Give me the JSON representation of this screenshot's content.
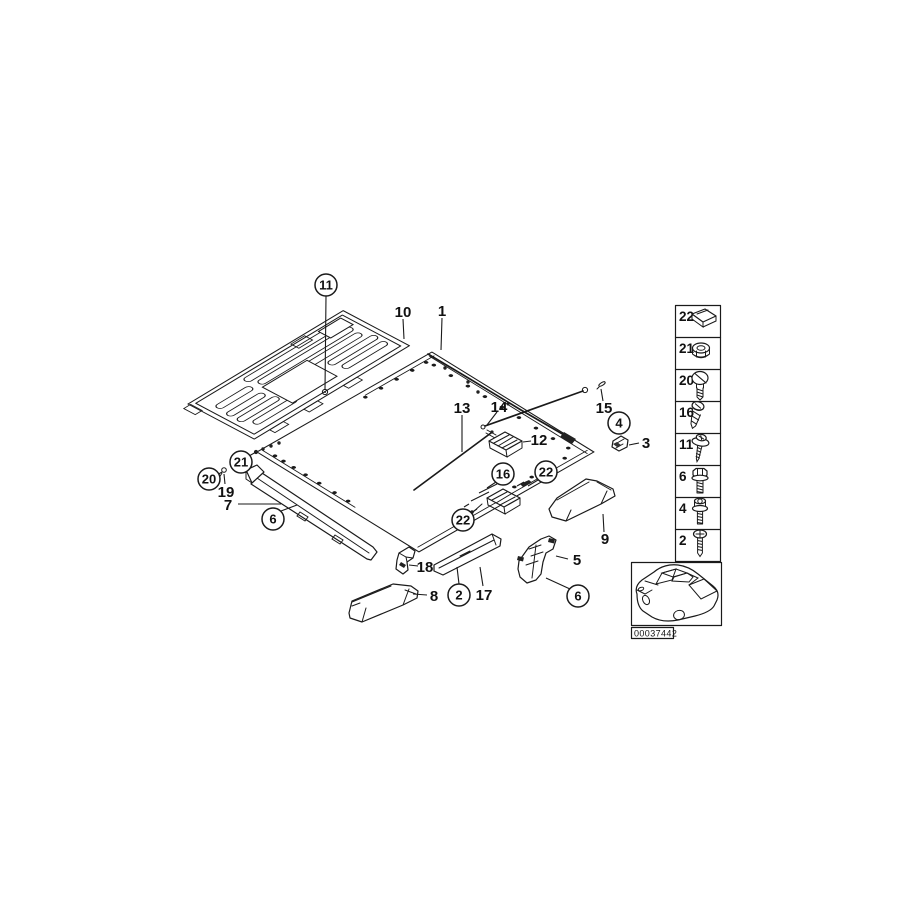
{
  "diagram": {
    "stamp_id": "00037442",
    "callouts": [
      {
        "label": "11",
        "circled": true,
        "x": 326,
        "y": 285
      },
      {
        "label": "10",
        "circled": false,
        "x": 403,
        "y": 312
      },
      {
        "label": "1",
        "circled": false,
        "x": 442,
        "y": 311
      },
      {
        "label": "13",
        "circled": false,
        "x": 462,
        "y": 408
      },
      {
        "label": "14",
        "circled": false,
        "x": 499,
        "y": 407
      },
      {
        "label": "15",
        "circled": false,
        "x": 604,
        "y": 408
      },
      {
        "label": "4",
        "circled": true,
        "x": 619,
        "y": 423
      },
      {
        "label": "3",
        "circled": false,
        "x": 646,
        "y": 443
      },
      {
        "label": "12",
        "circled": false,
        "x": 539,
        "y": 440
      },
      {
        "label": "16",
        "circled": true,
        "x": 503,
        "y": 474
      },
      {
        "label": "22",
        "circled": true,
        "x": 546,
        "y": 472
      },
      {
        "label": "22",
        "circled": true,
        "x": 463,
        "y": 520
      },
      {
        "label": "9",
        "circled": false,
        "x": 605,
        "y": 539
      },
      {
        "label": "21",
        "circled": true,
        "x": 241,
        "y": 462
      },
      {
        "label": "20",
        "circled": true,
        "x": 209,
        "y": 479
      },
      {
        "label": "19",
        "circled": false,
        "x": 226,
        "y": 492
      },
      {
        "label": "7",
        "circled": false,
        "x": 228,
        "y": 505
      },
      {
        "label": "6",
        "circled": true,
        "x": 273,
        "y": 519
      },
      {
        "label": "18",
        "circled": false,
        "x": 425,
        "y": 567
      },
      {
        "label": "8",
        "circled": false,
        "x": 434,
        "y": 596
      },
      {
        "label": "2",
        "circled": true,
        "x": 459,
        "y": 595
      },
      {
        "label": "17",
        "circled": false,
        "x": 484,
        "y": 595
      },
      {
        "label": "5",
        "circled": false,
        "x": 577,
        "y": 560
      },
      {
        "label": "6",
        "circled": true,
        "x": 578,
        "y": 596
      }
    ],
    "legend": {
      "rows": [
        {
          "number": "22",
          "icon": "clip-nut-icon"
        },
        {
          "number": "21",
          "icon": "flange-nut-icon"
        },
        {
          "number": "20",
          "icon": "slotted-screw-icon"
        },
        {
          "number": "16",
          "icon": "tapping-screw-icon"
        },
        {
          "number": "11",
          "icon": "washer-screw-icon"
        },
        {
          "number": "6",
          "icon": "hex-bolt-icon"
        },
        {
          "number": "4",
          "icon": "socket-bolt-icon"
        },
        {
          "number": "2",
          "icon": "phillips-screw-icon"
        }
      ]
    }
  }
}
